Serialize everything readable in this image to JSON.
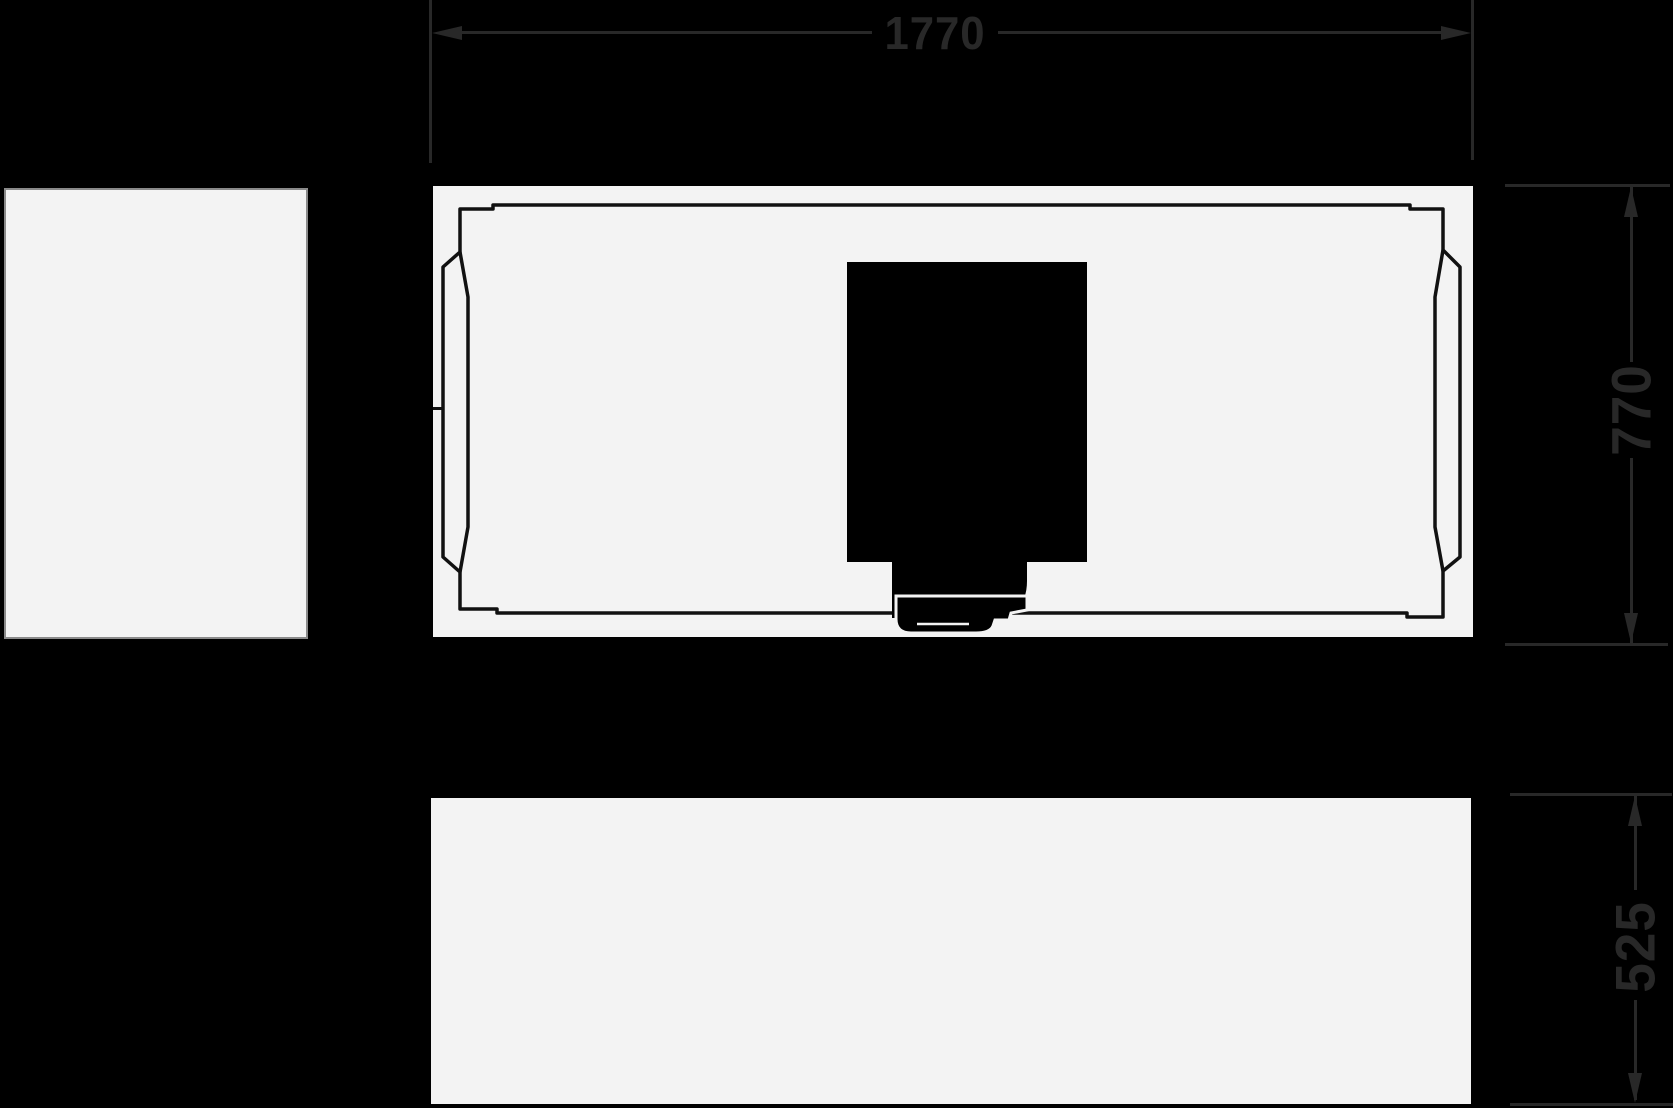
{
  "drawing": {
    "type": "bathtub-technical-drawing",
    "dimensions": {
      "width_mm": "1770",
      "depth_mm": "770",
      "height_mm": "525"
    },
    "colors": {
      "background": "#000000",
      "panel": "#f3f3f3",
      "outline": "#111111",
      "dimension": "#282828"
    }
  }
}
